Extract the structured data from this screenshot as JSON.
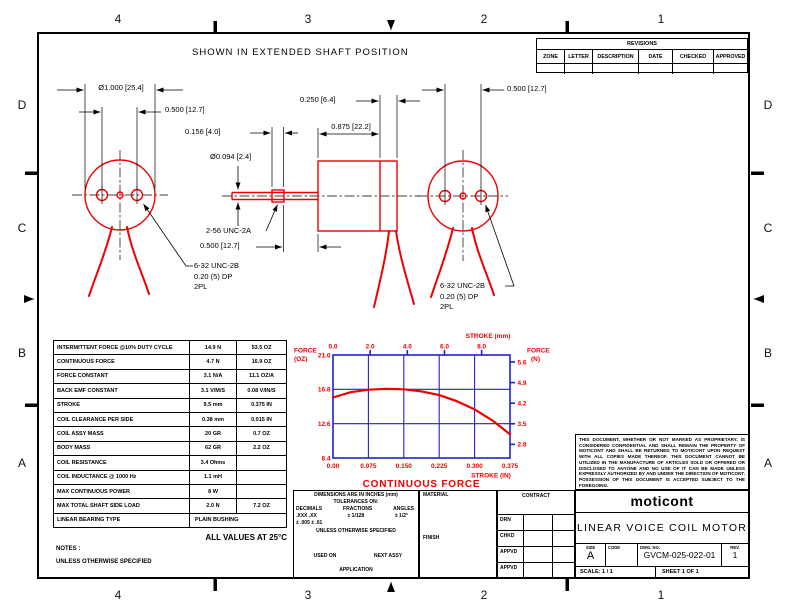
{
  "colors": {
    "drawing_red": "#ee0000",
    "grid_blue": "#2121cc",
    "line_black": "#000000"
  },
  "border": {
    "top_labels": [
      "4",
      "3",
      "2",
      "1"
    ],
    "bottom_labels": [
      "4",
      "3",
      "2",
      "1"
    ],
    "left_labels": [
      "D",
      "C",
      "B",
      "A"
    ],
    "right_labels": [
      "D",
      "C",
      "B",
      "A"
    ]
  },
  "heading": "SHOWN IN EXTENDED SHAFT POSITION",
  "revisions": {
    "title": "REVISIONS",
    "columns": [
      "ZONE",
      "LETTER",
      "DESCRIPTION",
      "DATE",
      "CHECKED",
      "APPROVED"
    ]
  },
  "views": {
    "left_end_view": {
      "dim_outer_diameter": "Ø1.000 [25.4]",
      "dim_hole_spacing": "0.500 [12.7]",
      "tap_note_lines": [
        "6-32 UNC-2B",
        "0.20 (5) DP",
        "2PL"
      ]
    },
    "side_view": {
      "dim_front_plate": "0.250 [6.4]",
      "dim_body_length": "0.875 [22.2]",
      "dim_thread_length": "0.156 [4.0]",
      "dim_shaft_diameter": "Ø0.094 [2.4]",
      "shaft_thread_note": "2-56 UNC-2A",
      "dim_shaft_exposed": "0.500 [12.7]"
    },
    "right_end_view": {
      "dim_hole_spacing": "0.500 [12.7]",
      "tap_note_lines": [
        "6-32 UNC-2B",
        "0.20 (5) DP",
        "2PL"
      ]
    }
  },
  "spec_table": {
    "rows": [
      [
        "INTERMITTENT FORCE @10% DUTY CYCLE",
        "14.9 N",
        "53.5 OZ"
      ],
      [
        "CONTINUOUS FORCE",
        "4.7 N",
        "16.9 OZ"
      ],
      [
        "FORCE CONSTANT",
        "3.1 N/A",
        "11.1 OZ/A"
      ],
      [
        "BACK EMF CONSTANT",
        "3.1 V/M/S",
        "0.08 V/IN/S"
      ],
      [
        "STROKE",
        "9.5 mm",
        "0.375 IN"
      ],
      [
        "COIL CLEARANCE PER SIDE",
        "0.38 mm",
        "0.015 IN"
      ],
      [
        "COIL ASSY MASS",
        "20 GR",
        "0.7 OZ"
      ],
      [
        "BODY MASS",
        "62 GR",
        "2.2 OZ"
      ],
      [
        "COIL RESISTANCE",
        "3.4 Ohms",
        ""
      ],
      [
        "COIL INDUCTANCE @ 1000 Hz",
        "1.1 mH",
        ""
      ],
      [
        "MAX CONTINUOUS POWER",
        "8 W",
        ""
      ],
      [
        "MAX TOTAL SHAFT SIDE LOAD",
        "2.0 N",
        "7.2 OZ"
      ],
      [
        "LINEAR BEARING TYPE",
        "PLAIN BUSHING",
        null
      ]
    ]
  },
  "notes": {
    "all_values": "ALL VALUES AT 25°C",
    "notes_label": "NOTES :",
    "unless": "UNLESS OTHERWISE SPECIFIED"
  },
  "chart_data": {
    "type": "line",
    "title": "CONTINUOUS FORCE",
    "top_axis": {
      "label": "STROKE (mm)",
      "tick_labels": [
        "0.0",
        "2.0",
        "4.0",
        "6.0",
        "8.0"
      ],
      "range": [
        0,
        9.525
      ]
    },
    "bottom_axis": {
      "label": "STROKE (IN)",
      "tick_labels": [
        "0.00",
        "0.075",
        "0.150",
        "0.225",
        "0.300",
        "0.375"
      ],
      "range": [
        0,
        0.375
      ]
    },
    "left_axis": {
      "label": "FORCE (OZ)",
      "label_lines": [
        "FORCE",
        "(OZ)"
      ],
      "tick_labels": [
        "21.0",
        "16.8",
        "12.6",
        "8.4"
      ],
      "range": [
        8.4,
        21.0
      ]
    },
    "right_axis": {
      "label": "FORCE (N)",
      "label_lines": [
        "FORCE",
        "(N)"
      ],
      "tick_labels": [
        "5.6",
        "4.9",
        "4.2",
        "3.5",
        "2.8"
      ]
    },
    "grid": {
      "v_lines_in": [
        0.075,
        0.15,
        0.225,
        0.3
      ],
      "h_lines_oz": [
        16.8,
        12.6
      ]
    },
    "series": [
      {
        "name": "CONTINUOUS FORCE",
        "color": "#ee0000",
        "points_in_oz": [
          [
            0,
            15.8
          ],
          [
            0.0375,
            16.45
          ],
          [
            0.075,
            16.75
          ],
          [
            0.1125,
            16.85
          ],
          [
            0.15,
            16.8
          ],
          [
            0.1875,
            16.55
          ],
          [
            0.225,
            16.1
          ],
          [
            0.2625,
            15.35
          ],
          [
            0.3,
            14.35
          ],
          [
            0.3375,
            13.0
          ],
          [
            0.375,
            11.3
          ]
        ]
      }
    ]
  },
  "tolerance_block": {
    "line1": "DIMENSIONS ARE IN INCHES (mm)",
    "line2": "TOLERANCES ON:",
    "col_headers": [
      "DECIMALS",
      "FRACTIONS",
      "ANGLES"
    ],
    "decimals": ".XXX  .XX",
    "fractions": "±  1/128",
    "angles": "± 1/2°",
    "decimals_tol": "± .005 ± .01",
    "line6": "UNLESS OTHERWISE SPECIFIED",
    "used_on": "USED ON",
    "next_assy": "NEXT ASSY",
    "application": "APPLICATION"
  },
  "material_block": {
    "material": "MATERIAL",
    "finish": "FINISH"
  },
  "contract_block": {
    "contract": "CONTRACT",
    "rows": [
      "DRN",
      "CHKD",
      "APPVD",
      "APPVD"
    ]
  },
  "legal": "THIS DOCUMENT, WHETHER OR NOT MARKED AS PROPRIETARY, IS CONSIDERED CONFIDENTIAL AND SHALL REMAIN THE PROPERTY OF MOTICONT AND SHALL BE RETURNED TO MOTICONT UPON REQUEST WITH ALL COPIES MADE THEREOF. THIS DOCUMENT CANNOT BE UTILIZED IN THE MANUFACTURE OF ARTICLES SOLD OR OFFERED OR DISCLOSED TO ANYONE AND NO USE OF IT CAN BE MADE UNLESS EXPRESSLY AUTHORIZED BY AND UNDER THE DIRECTION OF MOTICONT. POSSESSION OF THIS DOCUMENT IS ACCEPTED SUBJECT TO THE FOREGOING.",
  "title_block": {
    "company": "moticont",
    "title": "LINEAR VOICE COIL MOTOR",
    "size_label": "SIZE",
    "size": "A",
    "code_label": "CODE",
    "dwg_label": "DWG. NO.",
    "dwg_no": "GVCM-025-022-01",
    "rev_label": "REV.",
    "rev": "1",
    "scale": "SCALE:   1  / 1",
    "sheet": "SHEET   1   OF    1"
  }
}
